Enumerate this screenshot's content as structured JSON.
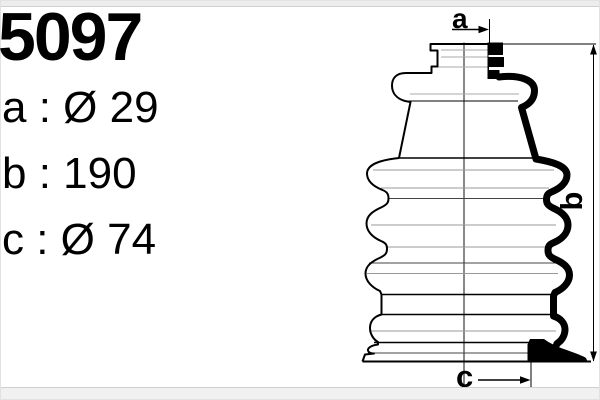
{
  "product": {
    "part_number": "5097"
  },
  "specs": [
    {
      "id": "a",
      "letter": "a",
      "value": "Ø 29",
      "display": "a : Ø 29"
    },
    {
      "id": "b",
      "letter": "b",
      "value": "190",
      "display": "b : 190"
    },
    {
      "id": "c",
      "letter": "c",
      "value": "Ø 74",
      "display": "c : Ø 74"
    }
  ],
  "diagram": {
    "markers": {
      "a": "a",
      "b": "b",
      "c": "c"
    }
  },
  "colors": {
    "ink": "#000000",
    "fold_line_gray": "#999999",
    "frame_strip": "#ededed",
    "frame_edge": "#cfcfcf"
  }
}
